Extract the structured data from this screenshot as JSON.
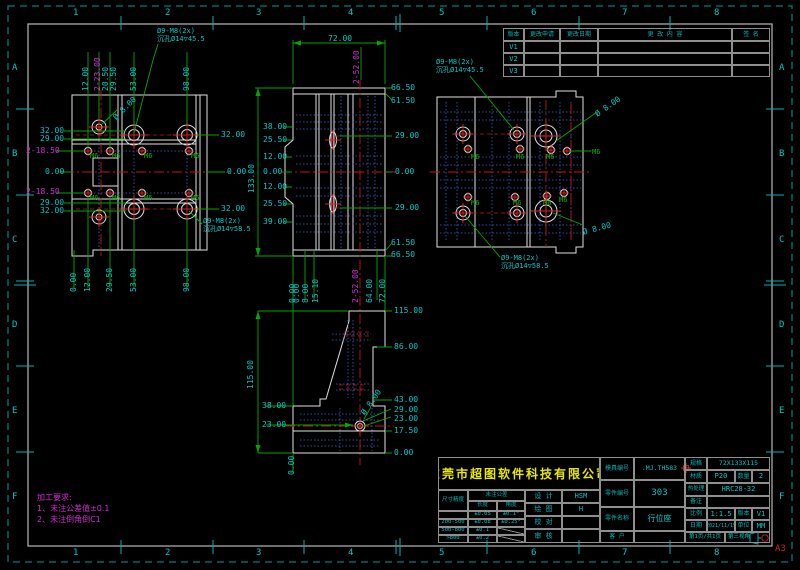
{
  "colors": {
    "cyan": "#00c8c8",
    "magenta": "#d428d4",
    "green": "#00b400",
    "yellow": "#e8e800",
    "red": "#d22020",
    "white": "#e0e0e0"
  },
  "sheet": {
    "size": "A3",
    "zone_cols": [
      "1",
      "2",
      "3",
      "4",
      "5",
      "6",
      "7",
      "8"
    ],
    "zone_rows": [
      "A",
      "B",
      "C",
      "D",
      "E",
      "F"
    ]
  },
  "revision": {
    "headers": [
      "版本",
      "更改申请",
      "更改日期",
      "更 改 内 容",
      "签 名"
    ],
    "rows": [
      "V1",
      "V2",
      "V3"
    ]
  },
  "notes": {
    "line1": "加工要求:",
    "line2": "1、未注公差值±0.1",
    "line3": "2、未注倒角倒C1"
  },
  "title_block": {
    "company": "东莞市超图软件科技有限公司",
    "tolerance": {
      "corner": "尺寸精度",
      "group_header": "未注公差",
      "col1": "长度",
      "col2": "角度",
      "rows": [
        [
          "",
          "±0.05",
          "±0.1°"
        ],
        [
          "200-500",
          "±0.08",
          "±0.25°"
        ],
        [
          "500-800",
          "±0.1",
          ""
        ],
        [
          ">800",
          "±0.2",
          ""
        ]
      ]
    },
    "signoff": [
      {
        "label": "设 计",
        "value": "HSM"
      },
      {
        "label": "绘 图",
        "value": "H"
      },
      {
        "label": "校 对",
        "value": ""
      },
      {
        "label": "审 核",
        "value": ""
      }
    ],
    "fields": {
      "mold_no_label": "模具编号",
      "mold_no": ".MJ.TH583",
      "part_no_label": "零件编号",
      "part_no": "303",
      "part_name_label": "零件名称",
      "part_name": "行位座",
      "customer_label": "客 户",
      "customer": "",
      "spec_label": "规格",
      "spec": "72X133X115",
      "material_label": "材质",
      "material": "P20",
      "qty_label": "数量",
      "qty": "2",
      "heat_label": "热处理",
      "heat": "HRC28-32",
      "remark_label": "备注",
      "remark": "",
      "scale_label": "比例",
      "scale": "1:1.5",
      "ver_label": "版本",
      "ver": "V1",
      "date_label": "日期",
      "date": "2021/11/15",
      "unit_label": "单位",
      "unit": "MM",
      "page": "第1页/共1页",
      "angle": "第三视角"
    }
  },
  "labels": [
    {
      "t": "1",
      "x": 73,
      "y": 9,
      "s": 9,
      "n": "zone-label"
    },
    {
      "t": "2",
      "x": 165,
      "y": 9,
      "s": 9,
      "n": "zone-label"
    },
    {
      "t": "3",
      "x": 256,
      "y": 9,
      "s": 9,
      "n": "zone-label"
    },
    {
      "t": "4",
      "x": 348,
      "y": 9,
      "s": 9,
      "n": "zone-label"
    },
    {
      "t": "5",
      "x": 439,
      "y": 9,
      "s": 9,
      "n": "zone-label"
    },
    {
      "t": "6",
      "x": 531,
      "y": 9,
      "s": 9,
      "n": "zone-label"
    },
    {
      "t": "7",
      "x": 622,
      "y": 9,
      "s": 9,
      "n": "zone-label"
    },
    {
      "t": "8",
      "x": 714,
      "y": 9,
      "s": 9,
      "n": "zone-label"
    },
    {
      "t": "1",
      "x": 73,
      "y": 549,
      "s": 9,
      "n": "zone-label"
    },
    {
      "t": "2",
      "x": 165,
      "y": 549,
      "s": 9,
      "n": "zone-label"
    },
    {
      "t": "3",
      "x": 256,
      "y": 549,
      "s": 9,
      "n": "zone-label"
    },
    {
      "t": "4",
      "x": 348,
      "y": 549,
      "s": 9,
      "n": "zone-label"
    },
    {
      "t": "5",
      "x": 439,
      "y": 549,
      "s": 9,
      "n": "zone-label"
    },
    {
      "t": "6",
      "x": 531,
      "y": 549,
      "s": 9,
      "n": "zone-label"
    },
    {
      "t": "7",
      "x": 622,
      "y": 549,
      "s": 9,
      "n": "zone-label"
    },
    {
      "t": "8",
      "x": 714,
      "y": 549,
      "s": 9,
      "n": "zone-label"
    },
    {
      "t": "A",
      "x": 12,
      "y": 64,
      "s": 9,
      "n": "zone-label"
    },
    {
      "t": "B",
      "x": 12,
      "y": 150,
      "s": 9,
      "n": "zone-label"
    },
    {
      "t": "C",
      "x": 12,
      "y": 236,
      "s": 9,
      "n": "zone-label"
    },
    {
      "t": "D",
      "x": 12,
      "y": 321,
      "s": 9,
      "n": "zone-label"
    },
    {
      "t": "E",
      "x": 12,
      "y": 407,
      "s": 9,
      "n": "zone-label"
    },
    {
      "t": "F",
      "x": 12,
      "y": 493,
      "s": 9,
      "n": "zone-label"
    },
    {
      "t": "A",
      "x": 779,
      "y": 64,
      "s": 9,
      "n": "zone-label"
    },
    {
      "t": "B",
      "x": 779,
      "y": 150,
      "s": 9,
      "n": "zone-label"
    },
    {
      "t": "C",
      "x": 779,
      "y": 236,
      "s": 9,
      "n": "zone-label"
    },
    {
      "t": "D",
      "x": 779,
      "y": 321,
      "s": 9,
      "n": "zone-label"
    },
    {
      "t": "E",
      "x": 779,
      "y": 407,
      "s": 9,
      "n": "zone-label"
    },
    {
      "t": "F",
      "x": 779,
      "y": 493,
      "s": 9,
      "n": "zone-label"
    },
    {
      "t": "A3",
      "x": 775,
      "y": 545,
      "c": "red",
      "s": 9,
      "n": "sheet-size-label"
    },
    {
      "t": "12.00",
      "x": 82,
      "y": 91,
      "r": -90
    },
    {
      "t": "2-23.00",
      "x": 94,
      "y": 91,
      "r": -90,
      "c": "magenta"
    },
    {
      "t": "20.50",
      "x": 102,
      "y": 91,
      "r": -90
    },
    {
      "t": "29.50",
      "x": 110,
      "y": 91,
      "r": -90
    },
    {
      "t": "53.00",
      "x": 130,
      "y": 91,
      "r": -90
    },
    {
      "t": "98.00",
      "x": 183,
      "y": 91,
      "r": -90
    },
    {
      "t": "0.00",
      "x": 70,
      "y": 292,
      "r": -90
    },
    {
      "t": "12.00",
      "x": 84,
      "y": 292,
      "r": -90
    },
    {
      "t": "29.50",
      "x": 106,
      "y": 292,
      "r": -90
    },
    {
      "t": "53.00",
      "x": 130,
      "y": 292,
      "r": -90
    },
    {
      "t": "98.00",
      "x": 183,
      "y": 292,
      "r": -90
    },
    {
      "t": "32.00",
      "x": 40,
      "y": 127
    },
    {
      "t": "29.00",
      "x": 40,
      "y": 135
    },
    {
      "t": "2-18.50",
      "x": 26,
      "y": 147,
      "c": "magenta"
    },
    {
      "t": "0.00",
      "x": 45,
      "y": 168
    },
    {
      "t": "2-18.50",
      "x": 26,
      "y": 188,
      "c": "magenta"
    },
    {
      "t": "29.00",
      "x": 40,
      "y": 199
    },
    {
      "t": "32.00",
      "x": 40,
      "y": 207
    },
    {
      "t": "32.00",
      "x": 221,
      "y": 131
    },
    {
      "t": "0.00",
      "x": 227,
      "y": 168
    },
    {
      "t": "32.00",
      "x": 221,
      "y": 205
    },
    {
      "t": "Ø9-M8(2x)",
      "x": 157,
      "y": 28,
      "s": 7,
      "n": "hole-callout"
    },
    {
      "t": "沉孔Ø14▽45.5",
      "x": 157,
      "y": 36,
      "s": 7,
      "n": "hole-callout"
    },
    {
      "t": "Ø 8.00",
      "x": 112,
      "y": 116,
      "r": -45
    },
    {
      "t": "Ø9-M8(2x)",
      "x": 203,
      "y": 218,
      "s": 7,
      "n": "hole-callout"
    },
    {
      "t": "沉孔Ø14▽58.5",
      "x": 203,
      "y": 226,
      "s": 7,
      "n": "hole-callout"
    },
    {
      "t": "M6",
      "x": 90,
      "y": 153,
      "c": "green",
      "s": 7,
      "n": "thread-label"
    },
    {
      "t": "M6",
      "x": 112,
      "y": 153,
      "c": "green",
      "s": 7,
      "n": "thread-label"
    },
    {
      "t": "M6",
      "x": 144,
      "y": 153,
      "c": "green",
      "s": 7,
      "n": "thread-label"
    },
    {
      "t": "M6",
      "x": 191,
      "y": 153,
      "c": "green",
      "s": 7,
      "n": "thread-label"
    },
    {
      "t": "M6",
      "x": 90,
      "y": 195,
      "c": "green",
      "s": 7,
      "n": "thread-label"
    },
    {
      "t": "M6",
      "x": 112,
      "y": 195,
      "c": "green",
      "s": 7,
      "n": "thread-label"
    },
    {
      "t": "M6",
      "x": 144,
      "y": 195,
      "c": "green",
      "s": 7,
      "n": "thread-label"
    },
    {
      "t": "M6",
      "x": 191,
      "y": 195,
      "c": "green",
      "s": 7,
      "n": "thread-label"
    },
    {
      "t": "72.00",
      "x": 328,
      "y": 35
    },
    {
      "t": "2-52.00",
      "x": 353,
      "y": 84,
      "r": -90,
      "c": "magenta"
    },
    {
      "t": "66.50",
      "x": 391,
      "y": 84
    },
    {
      "t": "61.50",
      "x": 391,
      "y": 97
    },
    {
      "t": "29.00",
      "x": 395,
      "y": 132
    },
    {
      "t": "0.00",
      "x": 395,
      "y": 168
    },
    {
      "t": "29.00",
      "x": 395,
      "y": 204
    },
    {
      "t": "61.50",
      "x": 391,
      "y": 239
    },
    {
      "t": "66.50",
      "x": 391,
      "y": 251
    },
    {
      "t": "38.00",
      "x": 263,
      "y": 123
    },
    {
      "t": "25.50",
      "x": 263,
      "y": 136
    },
    {
      "t": "12.00",
      "x": 263,
      "y": 153
    },
    {
      "t": "0.00",
      "x": 263,
      "y": 168
    },
    {
      "t": "12.00",
      "x": 263,
      "y": 183
    },
    {
      "t": "25.50",
      "x": 263,
      "y": 200
    },
    {
      "t": "39.00",
      "x": 263,
      "y": 218
    },
    {
      "t": "133.00",
      "x": 248,
      "y": 193,
      "r": -90
    },
    {
      "t": "0.00",
      "x": 289,
      "y": 303,
      "r": -90
    },
    {
      "t": "0.00",
      "x": 293,
      "y": 303,
      "r": -90
    },
    {
      "t": "8.00",
      "x": 302,
      "y": 303,
      "r": -90
    },
    {
      "t": "15.10",
      "x": 312,
      "y": 303,
      "r": -90
    },
    {
      "t": "2-52.00",
      "x": 352,
      "y": 303,
      "r": -90,
      "c": "magenta"
    },
    {
      "t": "64.00",
      "x": 366,
      "y": 303,
      "r": -90
    },
    {
      "t": "72.00",
      "x": 379,
      "y": 303,
      "r": -90
    },
    {
      "t": "Ø9-M8(2x)",
      "x": 436,
      "y": 59,
      "s": 7,
      "n": "hole-callout"
    },
    {
      "t": "沉孔Ø14▽45.5",
      "x": 436,
      "y": 67,
      "s": 7,
      "n": "hole-callout"
    },
    {
      "t": "Ø 8.00",
      "x": 594,
      "y": 112,
      "r": -35
    },
    {
      "t": "M6",
      "x": 592,
      "y": 149,
      "c": "green",
      "s": 7,
      "n": "thread-label"
    },
    {
      "t": "Ø 8.00",
      "x": 582,
      "y": 229,
      "r": -15
    },
    {
      "t": "Ø9-M8(2x)",
      "x": 501,
      "y": 255,
      "s": 7,
      "n": "hole-callout"
    },
    {
      "t": "沉孔Ø14▽58.5",
      "x": 501,
      "y": 263,
      "s": 7,
      "n": "hole-callout"
    },
    {
      "t": "M6",
      "x": 471,
      "y": 154,
      "c": "green",
      "s": 7,
      "n": "thread-label"
    },
    {
      "t": "M6",
      "x": 516,
      "y": 154,
      "c": "green",
      "s": 7,
      "n": "thread-label"
    },
    {
      "t": "M6",
      "x": 546,
      "y": 154,
      "c": "green",
      "s": 7,
      "n": "thread-label"
    },
    {
      "t": "M6",
      "x": 471,
      "y": 200,
      "c": "green",
      "s": 7,
      "n": "thread-label"
    },
    {
      "t": "M6",
      "x": 513,
      "y": 200,
      "c": "green",
      "s": 7,
      "n": "thread-label"
    },
    {
      "t": "M6",
      "x": 543,
      "y": 200,
      "c": "green",
      "s": 7,
      "n": "thread-label"
    },
    {
      "t": "M6",
      "x": 559,
      "y": 197,
      "c": "green",
      "s": 7,
      "n": "thread-label"
    },
    {
      "t": "115.00",
      "x": 394,
      "y": 307
    },
    {
      "t": "86.00",
      "x": 394,
      "y": 343
    },
    {
      "t": "43.00",
      "x": 394,
      "y": 396
    },
    {
      "t": "29.00",
      "x": 394,
      "y": 406
    },
    {
      "t": "23.00",
      "x": 394,
      "y": 415
    },
    {
      "t": "17.50",
      "x": 394,
      "y": 427
    },
    {
      "t": "0.00",
      "x": 394,
      "y": 449
    },
    {
      "t": "115.00",
      "x": 247,
      "y": 389,
      "r": -90
    },
    {
      "t": "38.00",
      "x": 262,
      "y": 402
    },
    {
      "t": "23.00",
      "x": 262,
      "y": 421
    },
    {
      "t": "Ø 8.00",
      "x": 360,
      "y": 412,
      "r": -55
    },
    {
      "t": "0.00",
      "x": 288,
      "y": 475,
      "r": -90
    }
  ]
}
